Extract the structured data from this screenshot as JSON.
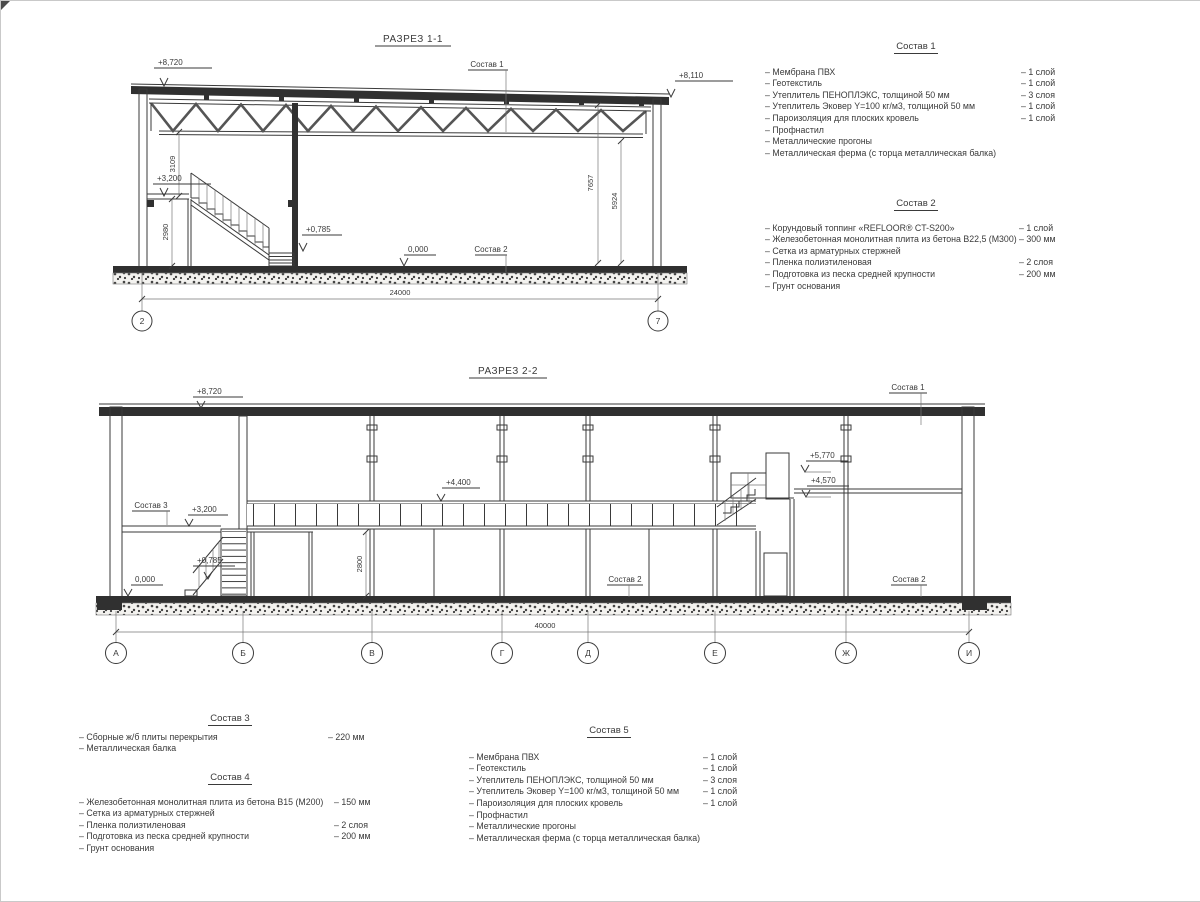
{
  "section1": {
    "title": "РАЗРЕЗ 1-1",
    "dim_width": "24000",
    "axes": [
      "2",
      "7"
    ],
    "dims": {
      "d3109": "3109",
      "d2980": "2980",
      "d7657": "7657",
      "d5924": "5924"
    },
    "elevations": {
      "top_left": "+8,720",
      "top_right": "+8,110",
      "mezzanine": "+3,200",
      "landing": "+0,785",
      "floor": "0,000"
    },
    "labels": {
      "sostav1": "Состав 1",
      "sostav2": "Состав 2"
    }
  },
  "section2": {
    "title": "РАЗРЕЗ 2-2",
    "dim_width": "40000",
    "axes": [
      "А",
      "Б",
      "В",
      "Г",
      "Д",
      "Е",
      "Ж",
      "И"
    ],
    "dims": {
      "d2800": "2800"
    },
    "elevations": {
      "roof": "+8,720",
      "deck": "+4,400",
      "platform_upper": "+5,770",
      "platform_lower": "+4,570",
      "mezzanine": "+3,200",
      "landing": "+0,785",
      "floor": "0,000"
    },
    "labels": {
      "sostav1": "Состав 1",
      "sostav2_mid": "Состав 2",
      "sostav2_right": "Состав 2",
      "sostav3": "Состав 3"
    }
  },
  "compositions": [
    {
      "title": "Состав 1",
      "items": [
        {
          "name": "– Мембрана ПВХ",
          "qty": "– 1 слой"
        },
        {
          "name": "– Геотекстиль",
          "qty": "– 1 слой"
        },
        {
          "name": "– Утеплитель ПЕНОПЛЭКС, толщиной 50 мм",
          "qty": "– 3 слоя"
        },
        {
          "name": "– Утеплитель Эковер Y=100 кг/м3, толщиной 50 мм",
          "qty": "– 1 слой"
        },
        {
          "name": "– Пароизоляция для плоских кровель",
          "qty": "– 1 слой"
        },
        {
          "name": "– Профнастил",
          "qty": ""
        },
        {
          "name": "– Металлические прогоны",
          "qty": ""
        },
        {
          "name": "– Металлическая ферма (с торца металлическая балка)",
          "qty": ""
        }
      ]
    },
    {
      "title": "Состав 2",
      "items": [
        {
          "name": "– Корундовый топпинг «REFLOOR® CT-S200»",
          "qty": "– 1 слой"
        },
        {
          "name": "– Железобетонная  монолитная плита из бетона В22,5 (М300)",
          "qty": "– 300 мм"
        },
        {
          "name": "– Сетка из арматурных стержней",
          "qty": ""
        },
        {
          "name": "– Пленка полиэтиленовая",
          "qty": "– 2 слоя"
        },
        {
          "name": "– Подготовка из песка средней крупности",
          "qty": "– 200 мм"
        },
        {
          "name": "– Грунт основания",
          "qty": ""
        }
      ]
    },
    {
      "title": "Состав 3",
      "items": [
        {
          "name": "– Сборные ж/б плиты перекрытия",
          "qty": "– 220 мм"
        },
        {
          "name": "– Металлическая балка",
          "qty": ""
        }
      ]
    },
    {
      "title": "Состав 4",
      "items": [
        {
          "name": "– Железобетонная  монолитная плита из бетона В15 (М200)",
          "qty": "– 150 мм"
        },
        {
          "name": "– Сетка из арматурных стержней",
          "qty": ""
        },
        {
          "name": "– Пленка полиэтиленовая",
          "qty": "– 2 слоя"
        },
        {
          "name": "– Подготовка из песка средней крупности",
          "qty": "– 200 мм"
        },
        {
          "name": "– Грунт основания",
          "qty": ""
        }
      ]
    },
    {
      "title": "Состав 5",
      "items": [
        {
          "name": "– Мембрана ПВХ",
          "qty": "– 1 слой"
        },
        {
          "name": "– Геотекстиль",
          "qty": "– 1 слой"
        },
        {
          "name": "– Утеплитель ПЕНОПЛЭКС, толщиной 50 мм",
          "qty": "– 3 слоя"
        },
        {
          "name": "– Утеплитель Эковер Y=100 кг/м3, толщиной 50 мм",
          "qty": "– 1 слой"
        },
        {
          "name": "– Пароизоляция для плоских кровель",
          "qty": "– 1 слой"
        },
        {
          "name": "– Профнастил",
          "qty": ""
        },
        {
          "name": "– Металлические прогоны",
          "qty": ""
        },
        {
          "name": "– Металлическая ферма (с торца металлическая балка)",
          "qty": ""
        }
      ]
    }
  ]
}
